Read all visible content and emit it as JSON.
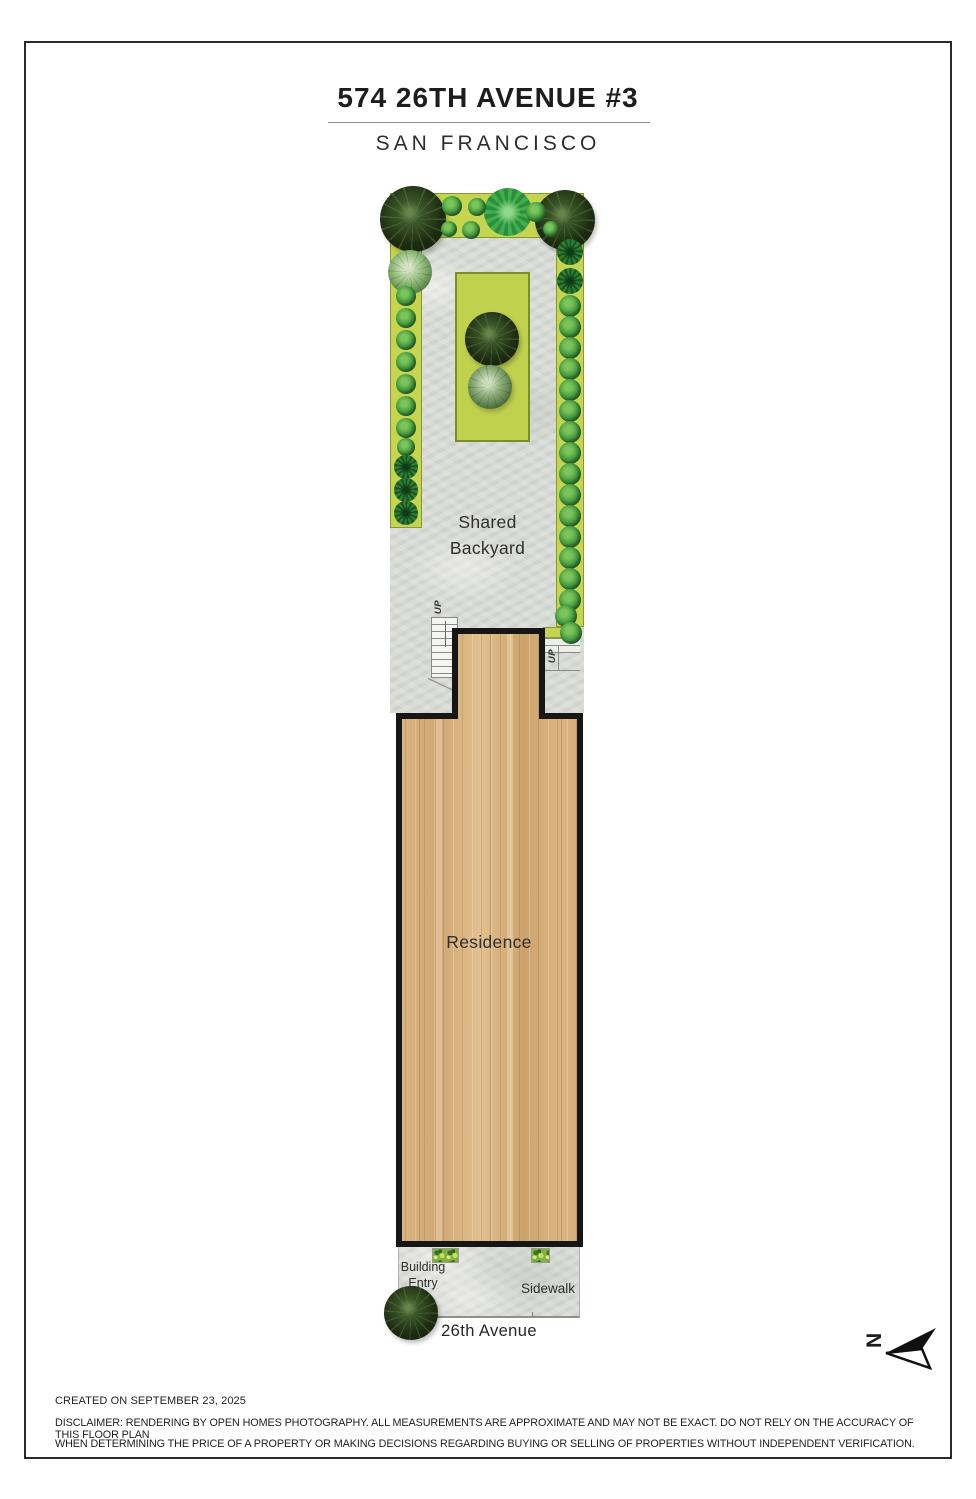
{
  "title": "574 26TH AVENUE #3",
  "subtitle": "SAN FRANCISCO",
  "plan": {
    "backyard_label_line1": "Shared",
    "backyard_label_line2": "Backyard",
    "residence_label": "Residence",
    "up_label_left": "UP",
    "up_label_right": "UP",
    "entry_label_line1": "Building",
    "entry_label_line2": "Entry",
    "sidewalk_label": "Sidewalk",
    "street_label": "26th Avenue",
    "north_label": "N",
    "plants": [
      {
        "type": "dark-tree",
        "x": 413,
        "y": 219,
        "r": 33
      },
      {
        "type": "dark-tree",
        "x": 565,
        "y": 220,
        "r": 30
      },
      {
        "type": "succulent",
        "x": 508,
        "y": 212,
        "r": 24
      },
      {
        "type": "shrub",
        "x": 452,
        "y": 206,
        "r": 10
      },
      {
        "type": "shrub",
        "x": 477,
        "y": 207,
        "r": 9
      },
      {
        "type": "shrub",
        "x": 449,
        "y": 229,
        "r": 8
      },
      {
        "type": "shrub",
        "x": 471,
        "y": 230,
        "r": 9
      },
      {
        "type": "shrub",
        "x": 536,
        "y": 212,
        "r": 10
      },
      {
        "type": "shrub",
        "x": 551,
        "y": 229,
        "r": 8
      },
      {
        "type": "light-shrub",
        "x": 410,
        "y": 272,
        "r": 22
      },
      {
        "type": "shrub",
        "x": 406,
        "y": 296,
        "r": 10
      },
      {
        "type": "shrub",
        "x": 406,
        "y": 318,
        "r": 10
      },
      {
        "type": "shrub",
        "x": 406,
        "y": 340,
        "r": 10
      },
      {
        "type": "shrub",
        "x": 406,
        "y": 362,
        "r": 10
      },
      {
        "type": "shrub",
        "x": 406,
        "y": 384,
        "r": 10
      },
      {
        "type": "shrub",
        "x": 406,
        "y": 406,
        "r": 10
      },
      {
        "type": "shrub",
        "x": 406,
        "y": 428,
        "r": 10
      },
      {
        "type": "shrub",
        "x": 406,
        "y": 447,
        "r": 9
      },
      {
        "type": "palm",
        "x": 406,
        "y": 467,
        "r": 12
      },
      {
        "type": "palm",
        "x": 406,
        "y": 490,
        "r": 12
      },
      {
        "type": "palm",
        "x": 406,
        "y": 513,
        "r": 12
      },
      {
        "type": "palm",
        "x": 570,
        "y": 252,
        "r": 13
      },
      {
        "type": "palm",
        "x": 570,
        "y": 281,
        "r": 13
      },
      {
        "type": "shrub",
        "x": 570,
        "y": 306,
        "r": 11
      },
      {
        "type": "shrub",
        "x": 570,
        "y": 327,
        "r": 11
      },
      {
        "type": "shrub",
        "x": 570,
        "y": 348,
        "r": 11
      },
      {
        "type": "shrub",
        "x": 570,
        "y": 369,
        "r": 11
      },
      {
        "type": "shrub",
        "x": 570,
        "y": 390,
        "r": 11
      },
      {
        "type": "shrub",
        "x": 570,
        "y": 411,
        "r": 11
      },
      {
        "type": "shrub",
        "x": 570,
        "y": 432,
        "r": 11
      },
      {
        "type": "shrub",
        "x": 570,
        "y": 453,
        "r": 11
      },
      {
        "type": "shrub",
        "x": 570,
        "y": 474,
        "r": 11
      },
      {
        "type": "shrub",
        "x": 570,
        "y": 495,
        "r": 11
      },
      {
        "type": "shrub",
        "x": 570,
        "y": 516,
        "r": 11
      },
      {
        "type": "shrub",
        "x": 570,
        "y": 537,
        "r": 11
      },
      {
        "type": "shrub",
        "x": 570,
        "y": 558,
        "r": 11
      },
      {
        "type": "shrub",
        "x": 570,
        "y": 579,
        "r": 11
      },
      {
        "type": "shrub",
        "x": 570,
        "y": 600,
        "r": 11
      },
      {
        "type": "shrub",
        "x": 566,
        "y": 616,
        "r": 11
      },
      {
        "type": "shrub",
        "x": 571,
        "y": 633,
        "r": 11
      },
      {
        "type": "dark-tree",
        "x": 492,
        "y": 339,
        "r": 27
      },
      {
        "type": "sage-tree",
        "x": 490,
        "y": 387,
        "r": 22
      },
      {
        "type": "dark-tree",
        "x": 411,
        "y": 1313,
        "r": 27
      }
    ]
  },
  "footer": {
    "created": "CREATED ON SEPTEMBER 23, 2025",
    "disclaimer_line1": "DISCLAIMER: RENDERING BY OPEN HOMES PHOTOGRAPHY. ALL MEASUREMENTS ARE APPROXIMATE AND MAY NOT BE EXACT. DO NOT RELY ON THE ACCURACY OF THIS FLOOR PLAN",
    "disclaimer_line2": "WHEN DETERMINING THE PRICE OF A PROPERTY OR MAKING DECISIONS REGARDING BUYING OR SELLING OF PROPERTIES WITHOUT INDEPENDENT VERIFICATION."
  },
  "colors": {
    "page_border": "#2b2b2b",
    "garden_green": "#c6d550",
    "garden_border": "#87982f",
    "lawn_green": "#c0d14e",
    "lawn_border": "#7b8e2d",
    "concrete_gray": "#d9dbd6",
    "wood_tan": "#d7af7d",
    "wall_black": "#161616",
    "stair_line": "#8a8a8a",
    "planter_green": "#84b13c",
    "text_dark": "#2b2b2b"
  }
}
